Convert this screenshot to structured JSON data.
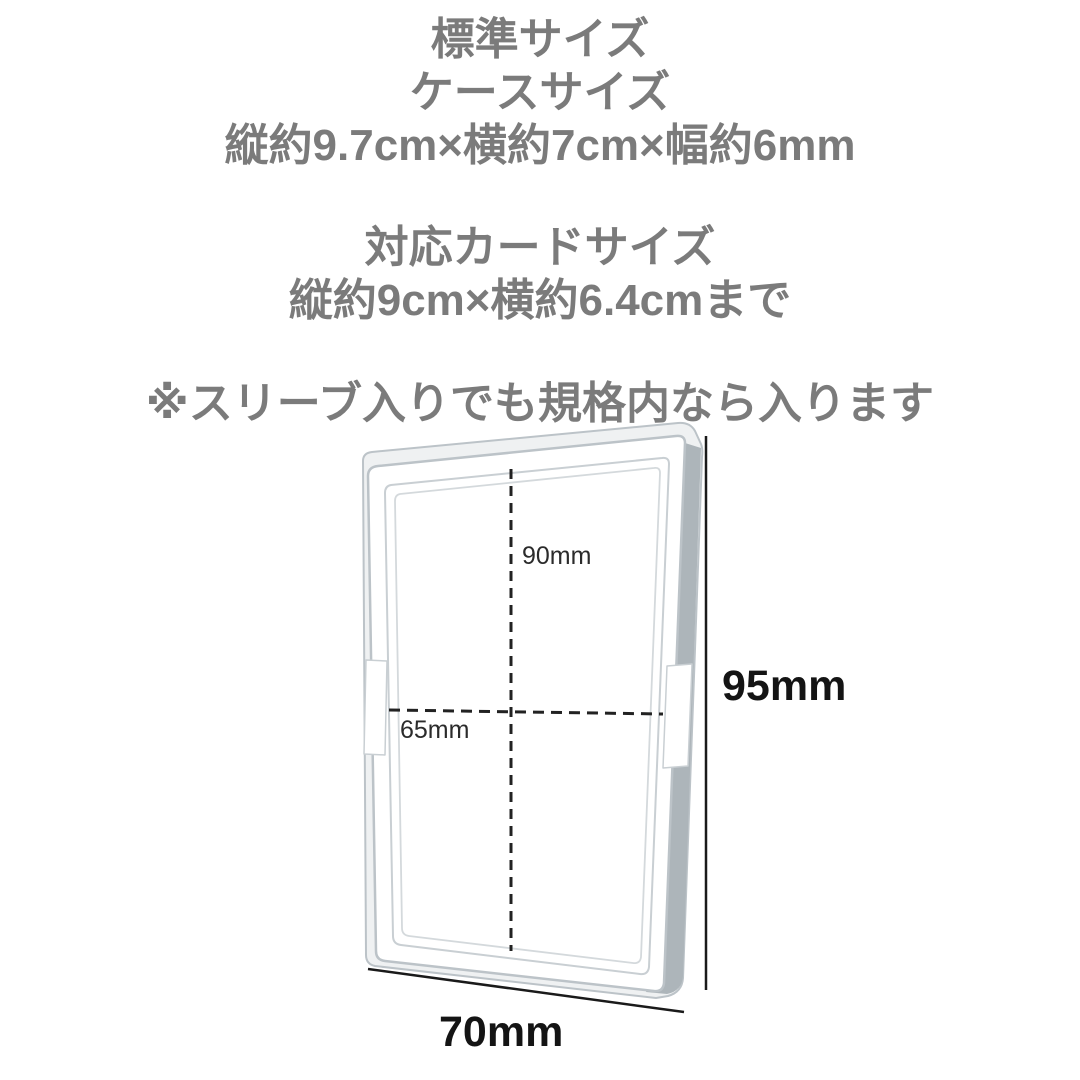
{
  "text": {
    "standard_size": "標準サイズ",
    "case_size_label": "ケースサイズ",
    "case_size_value": "縦約9.7cm×横約7cm×幅約6mm",
    "card_size_label": "対応カードサイズ",
    "card_size_value": "縦約9cm×横約6.4cmまで",
    "sleeve_note": "※スリーブ入りでも規格内なら入ります"
  },
  "diagram": {
    "card_height_label": "90mm",
    "card_width_label": "65mm",
    "case_height_label": "95mm",
    "case_width_label": "70mm"
  },
  "colors": {
    "background": "#ffffff",
    "heading_text_gray": "#7b7b7b",
    "dimension_text_dark": "#141414",
    "inner_dimension_text": "#2b2b2b",
    "case_outline": "#bcc3c8",
    "case_side_gray": "#adb5ba",
    "case_sliver_fill": "#eff1f2"
  }
}
